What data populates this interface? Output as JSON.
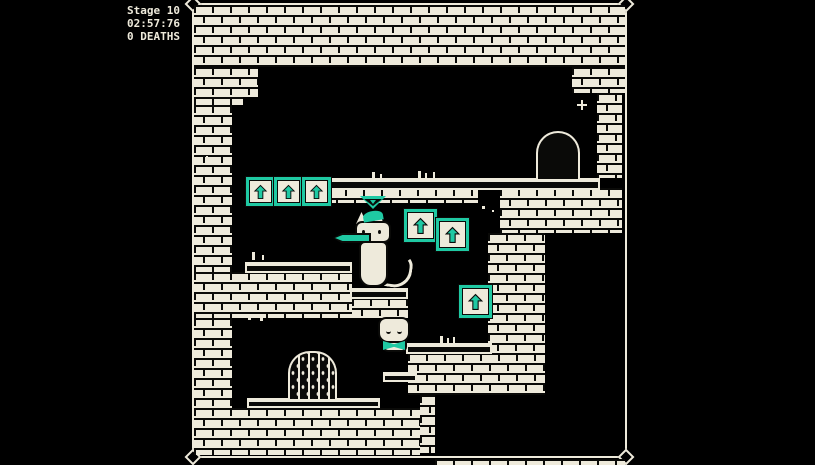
{
  "hud": {
    "stage": "Stage 10",
    "time": "02:57:76",
    "deaths": "0 DEATHS"
  },
  "colors": {
    "teal": "#1fc9a3",
    "cream": "#eeeadb",
    "ink": "#0a0a08",
    "bg": "#000000"
  },
  "level": {
    "arrow_block_count": 6,
    "arrow_direction": "up",
    "doorway_count": 2,
    "characters": [
      "tall-cat-player",
      "small-cat"
    ]
  }
}
